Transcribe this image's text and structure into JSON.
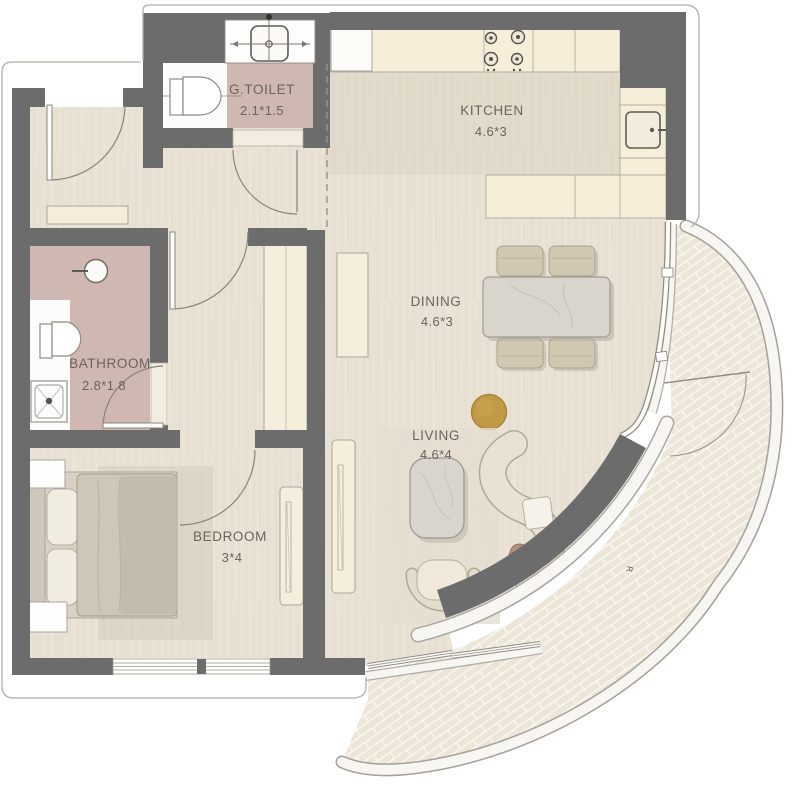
{
  "plan": {
    "type": "apartment-floor-plan",
    "rooms": [
      {
        "key": "g_toilet",
        "name": "G.TOILET",
        "dims": "2.1*1.5"
      },
      {
        "key": "kitchen",
        "name": "KITCHEN",
        "dims": "4.6*3"
      },
      {
        "key": "dining",
        "name": "DINING",
        "dims": "4.6*3"
      },
      {
        "key": "bathroom",
        "name": "BATHROOM",
        "dims": "2.8*1.8"
      },
      {
        "key": "living",
        "name": "LIVING",
        "dims": "4.6*4"
      },
      {
        "key": "bedroom",
        "name": "BEDROOM",
        "dims": "3*4"
      }
    ],
    "annotations": [
      {
        "text": "R"
      }
    ],
    "fixtures": [
      "entry-door",
      "g-toilet-washbasin",
      "g-toilet-wc",
      "kitchen-stove",
      "kitchen-fridge",
      "kitchen-sink",
      "dining-table",
      "dining-chairs",
      "bathroom-washbasin",
      "bathroom-wc",
      "bathroom-shower",
      "wardrobe",
      "bed",
      "nightstands",
      "tv-console-bedroom",
      "tv-console-living",
      "coffee-table",
      "armchair",
      "curved-sofa",
      "gold-side-table",
      "balcony-terrace",
      "curved-feature-wall"
    ],
    "colors": {
      "wall": "#6c6c6c",
      "floor": "#e9e2d4",
      "floor_kitchen": "#e2dbcb",
      "wet_room_floor": "#cfb8b2",
      "counter": "#f7eeda",
      "balcony_tile": "#ece5d8",
      "accent_gold": "#c09a45",
      "label_text": "#6a655c",
      "outline": "#b3aea6"
    }
  }
}
